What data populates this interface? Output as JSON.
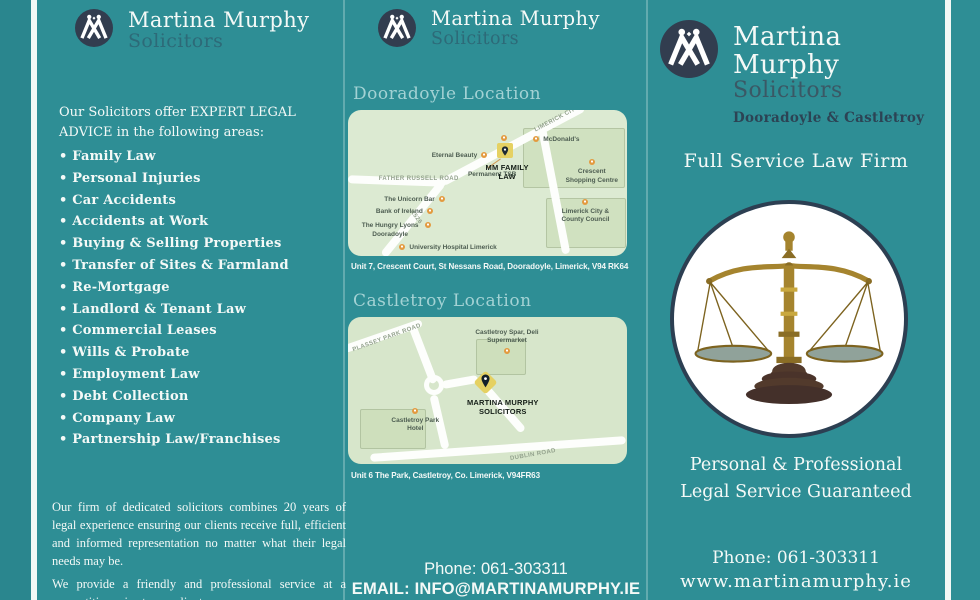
{
  "brand": {
    "name": "Martina Murphy",
    "subtitle": "Solicitors",
    "locations": "Dooradoyle & Castletroy"
  },
  "colors": {
    "background": "#2e8e95",
    "background_edge": "#2a868e",
    "fold_line": "#f2f8f5",
    "logo_circle": "#323d4f",
    "text": "#f4f9f7",
    "subtitle": "#2d6a78",
    "subtitle_right": "#3a5865",
    "locations_text": "#2c4354",
    "accent_heading": "#a3d2d4",
    "map_bg": "#dcead2",
    "map_bg_2": "#d7e6cb",
    "pin_orange": "#e39a3f",
    "marker_yellow": "#e5d162",
    "scales_border": "#2c3f52"
  },
  "left_panel": {
    "intro": "Our Solicitors offer EXPERT LEGAL ADVICE in the following areas:",
    "practice_areas": [
      "Family Law",
      "Personal Injuries",
      "Car Accidents",
      "Accidents at Work",
      "Buying & Selling Properties",
      "Transfer of Sites & Farmland",
      "Re-Mortgage",
      "Landlord & Tenant Law",
      "Commercial Leases",
      "Wills & Probate",
      "Employment Law",
      "Debt Collection",
      "Company Law",
      "Partnership Law/Franchises"
    ],
    "about_1": "Our firm of dedicated solicitors combines 20 years of legal experience ensuring our clients receive full, efficient and informed representation no matter what their legal needs may be.",
    "about_2": "We provide a friendly and professional service at a competitive price to our clients."
  },
  "middle_panel": {
    "dooradoyle": {
      "heading": "Dooradoyle Location",
      "address": "Unit 7, Crescent Court, St Nessans Road, Dooradoyle, Limerick, V94 RK64",
      "map_labels": [
        {
          "text": "LIMERICK CITY →",
          "x": 66,
          "y": 3,
          "rotate": -28,
          "cls": "road"
        },
        {
          "text": "McDonald's",
          "x": 70,
          "y": 18,
          "pin": "left"
        },
        {
          "text": "Eternal Beauty",
          "x": 30,
          "y": 29,
          "pin": "right"
        },
        {
          "text": "MM FAMILY LAW",
          "x": 47,
          "y": 36,
          "w": 56,
          "cls": "office"
        },
        {
          "text": "Permanent TSB",
          "x": 43,
          "y": 42
        },
        {
          "text": "Crescent Shopping Centre",
          "x": 77,
          "y": 40,
          "w": 58,
          "pin": "top"
        },
        {
          "text": "FATHER RUSSELL ROAD",
          "x": 11,
          "y": 45,
          "cls": "road"
        },
        {
          "text": "The Unicorn Bar",
          "x": 13,
          "y": 59,
          "pin": "right"
        },
        {
          "text": "Bank of Ireland",
          "x": 10,
          "y": 67,
          "pin": "right"
        },
        {
          "text": "Limerick City & County Council",
          "x": 74,
          "y": 67,
          "w": 62,
          "pin": "top"
        },
        {
          "text": "R526",
          "x": 21,
          "y": 71,
          "rotate": 53,
          "cls": "road"
        },
        {
          "text": "The Hungry Lyons Dooradoyle",
          "x": 4,
          "y": 77,
          "w": 62,
          "pin": "right"
        },
        {
          "text": "University Hospital Limerick",
          "x": 22,
          "y": 92,
          "pin": "left"
        }
      ]
    },
    "castletroy": {
      "heading": "Castletroy Location",
      "address": "Unit 6 The Park, Castletroy, Co. Limerick, V94FR63",
      "map_labels": [
        {
          "text": "PLASSEY PARK ROAD",
          "x": 1,
          "y": 12,
          "rotate": -20,
          "cls": "road"
        },
        {
          "text": "Castletroy Spar, Deli Supermarket",
          "x": 43,
          "y": 8,
          "w": 78,
          "pin": "bottom"
        },
        {
          "text": "MARTINA MURPHY SOLICITORS",
          "x": 39,
          "y": 55,
          "w": 92,
          "cls": "office"
        },
        {
          "text": "Castletroy Park Hotel",
          "x": 13,
          "y": 68,
          "w": 62,
          "pin": "top"
        },
        {
          "text": "DUBLIN ROAD",
          "x": 58,
          "y": 92,
          "rotate": -10,
          "cls": "road"
        }
      ]
    },
    "phone": "Phone: 061-303311",
    "email": "EMAIL: INFO@MARTINAMURPHY.IE"
  },
  "right_panel": {
    "tagline": "Full Service Law Firm",
    "guarantee_1": "Personal & Professional",
    "guarantee_2": "Legal Service Guaranteed",
    "phone": "Phone: 061-303311",
    "website": "www.martinamurphy.ie"
  }
}
